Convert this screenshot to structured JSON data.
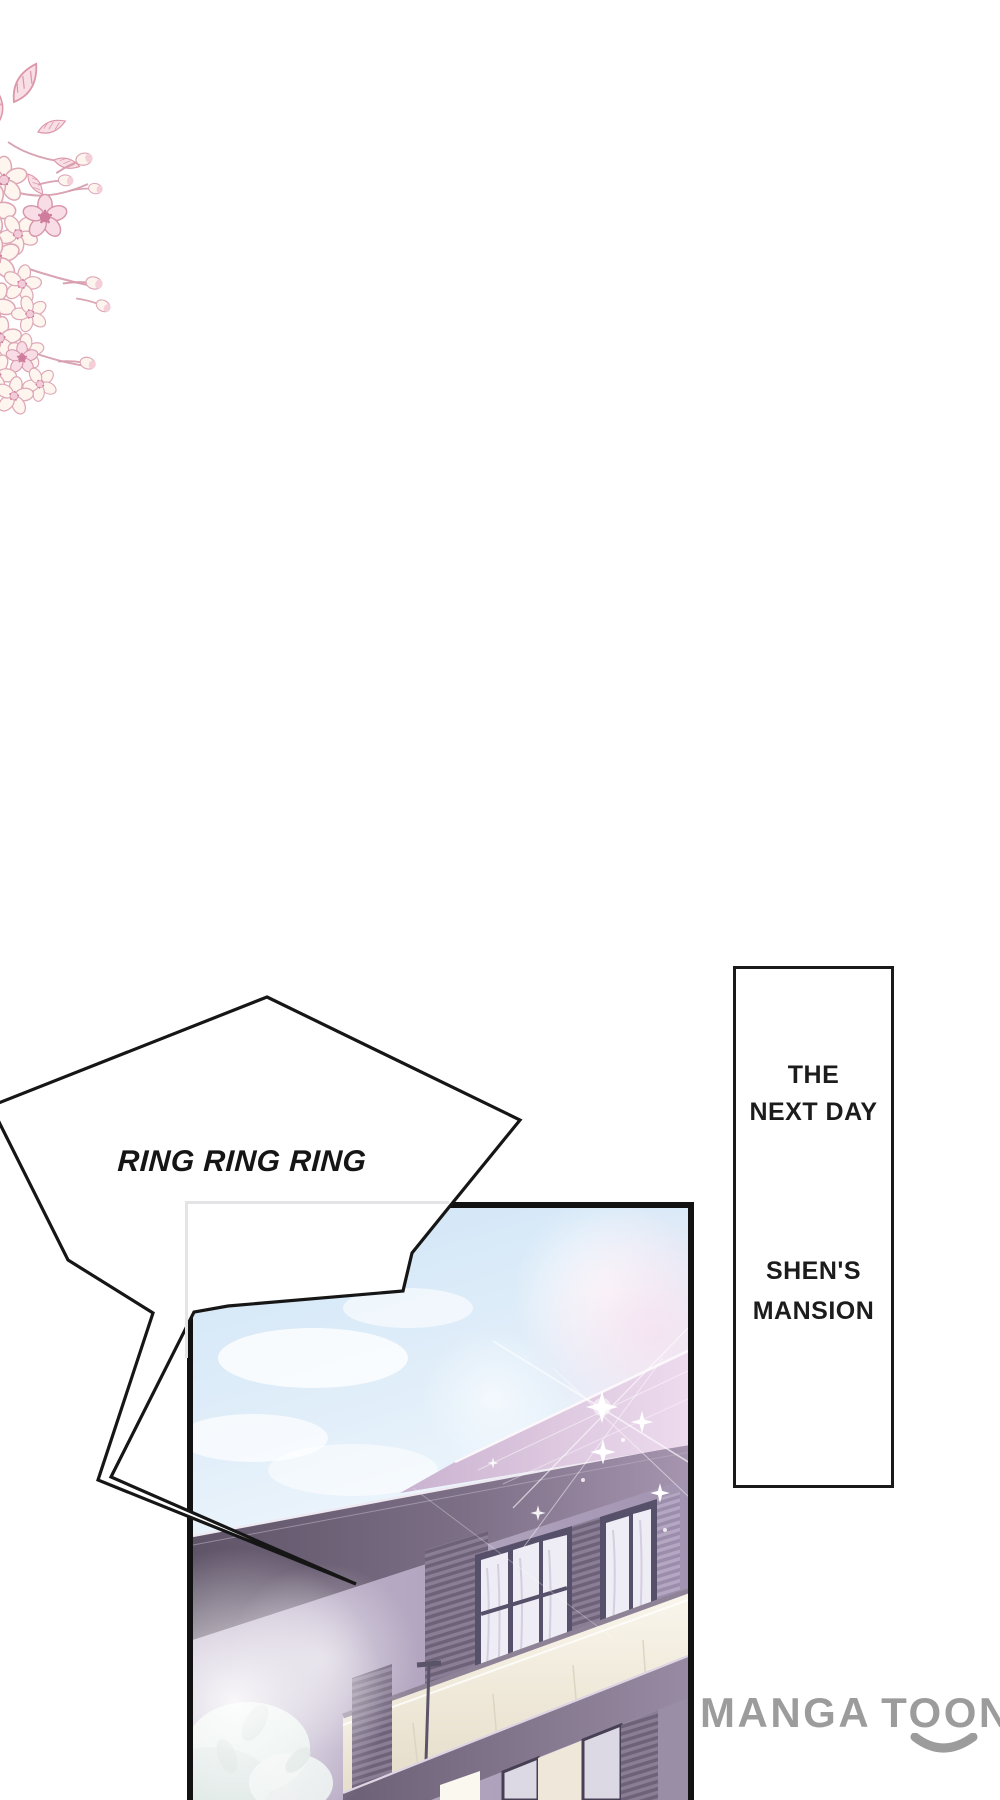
{
  "page": {
    "width": 1000,
    "height": 1800,
    "background": "#ffffff"
  },
  "decor": {
    "name": "cherry-blossom-branch",
    "petal_color": "#fdf5ee",
    "outline_color": "#dda7b6",
    "accent_pink": "#cf7d9d"
  },
  "sfx_bubble": {
    "text": "RING RING RING",
    "fill": "#ffffff",
    "outline": "#161616"
  },
  "caption_box": {
    "border_color": "#1a1a1a",
    "top_lines": [
      "THE",
      "NEXT DAY"
    ],
    "bottom_lines": [
      "SHEN'S",
      "MANSION"
    ]
  },
  "panel": {
    "scene": "mansion exterior under morning sky with sparkles",
    "sky_color": "#cfe4f6",
    "roof_color": "#6f6378",
    "flare_color": "#ecd9ec",
    "wall_color": "#a99cb7",
    "window_frame_color": "#4e4860",
    "curtain_color": "#eeecf4",
    "parapet_color": "#f6f1e4",
    "sparkle_color": "#ffffff"
  },
  "watermark": {
    "word1": "MANGA",
    "word2": "TOON",
    "color": "#9c9c9c"
  }
}
